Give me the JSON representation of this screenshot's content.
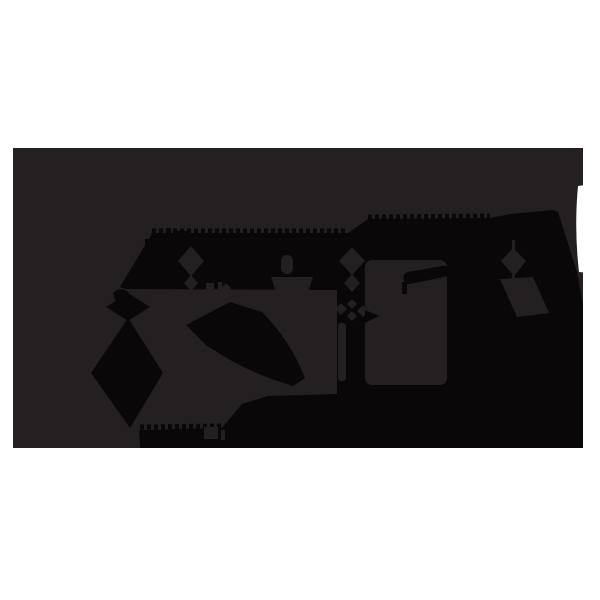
{
  "figure": {
    "description": "Abstract dark silhouette graphic: black scallop-edged band and mountain shapes with gray diamond-chain cutouts on a dark panel over a white page",
    "panel_label": "dark-panel",
    "motifs": [
      "scalloped band",
      "mountain peak",
      "diamond chain x3",
      "stacked diamonds lower-left",
      "rounded block cutout",
      "slanted bar detail",
      "white edge notch"
    ]
  },
  "colors": {
    "page_bg": "#ffffff",
    "panel": "#242021",
    "ink": "#0a0708",
    "white": "#ffffff"
  }
}
